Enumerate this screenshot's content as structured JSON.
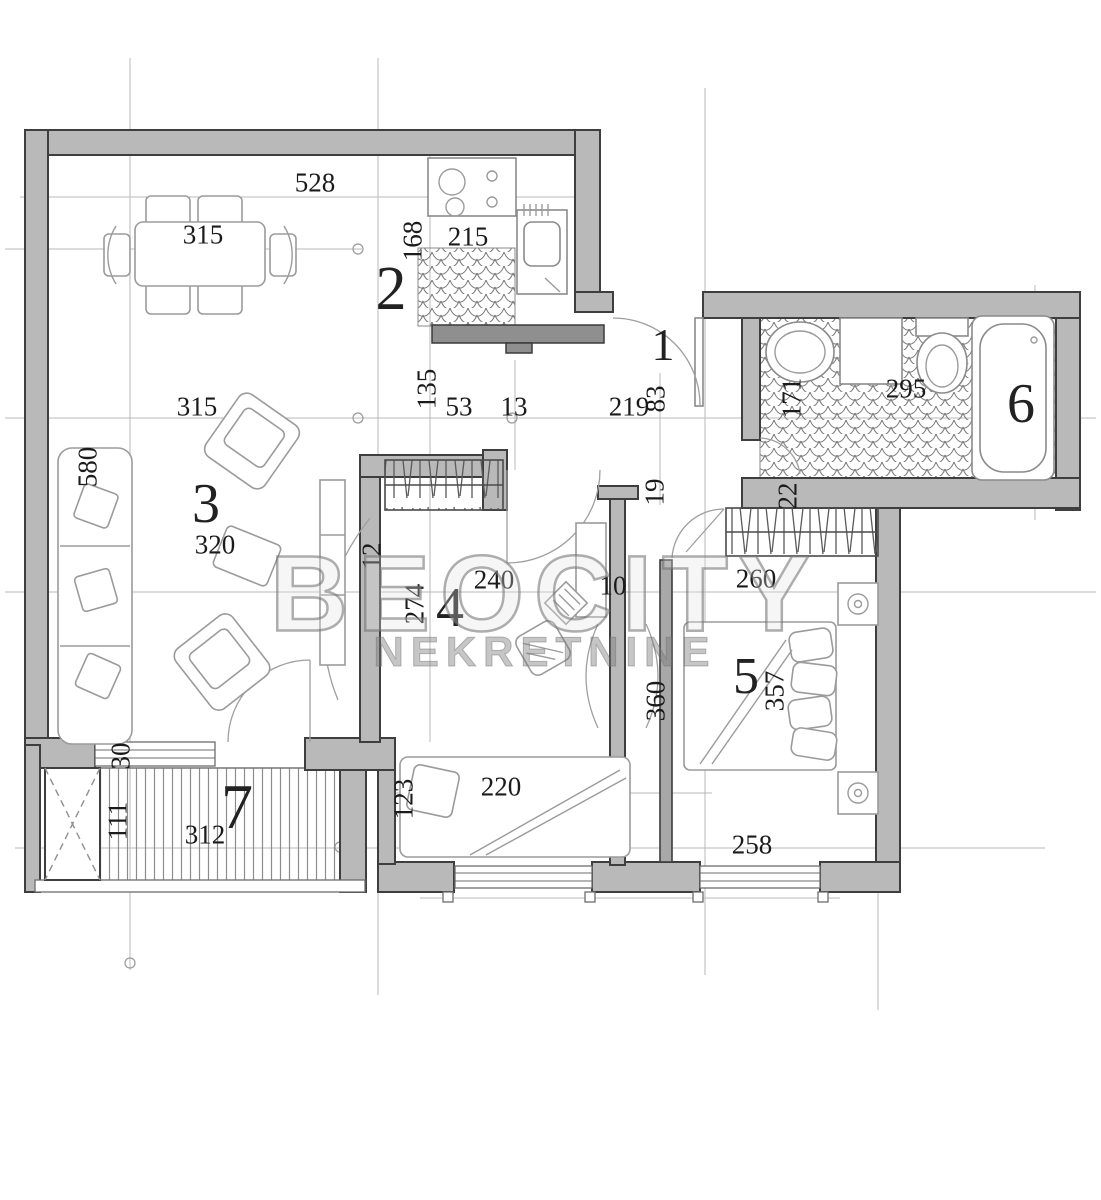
{
  "watermark": {
    "line1": "BEOCITY",
    "line2": "NEKRETNINE"
  },
  "colors": {
    "wall": "#b9b9b9",
    "wallStroke": "#3e3e3e",
    "furn": "#9b9b9b",
    "grid": "#b2b2b2",
    "ink": "#1b1b1b",
    "tile": "#7d7d7d",
    "wm": "#6f6f6f"
  },
  "rooms": [
    {
      "number": "1"
    },
    {
      "number": "2"
    },
    {
      "number": "3"
    },
    {
      "number": "4"
    },
    {
      "number": "5"
    },
    {
      "number": "6"
    },
    {
      "number": "7"
    }
  ],
  "dims": [
    {
      "text": "528"
    },
    {
      "text": "315"
    },
    {
      "text": "168"
    },
    {
      "text": "215"
    },
    {
      "text": "315"
    },
    {
      "text": "580"
    },
    {
      "text": "320"
    },
    {
      "text": "135"
    },
    {
      "text": "53"
    },
    {
      "text": "13"
    },
    {
      "text": "219"
    },
    {
      "text": "83"
    },
    {
      "text": "171"
    },
    {
      "text": "295"
    },
    {
      "text": "22"
    },
    {
      "text": "240"
    },
    {
      "text": "274"
    },
    {
      "text": "12"
    },
    {
      "text": "10"
    },
    {
      "text": "19"
    },
    {
      "text": "360"
    },
    {
      "text": "260"
    },
    {
      "text": "357"
    },
    {
      "text": "258"
    },
    {
      "text": "220"
    },
    {
      "text": "123"
    },
    {
      "text": "30"
    },
    {
      "text": "111"
    },
    {
      "text": "312"
    }
  ]
}
